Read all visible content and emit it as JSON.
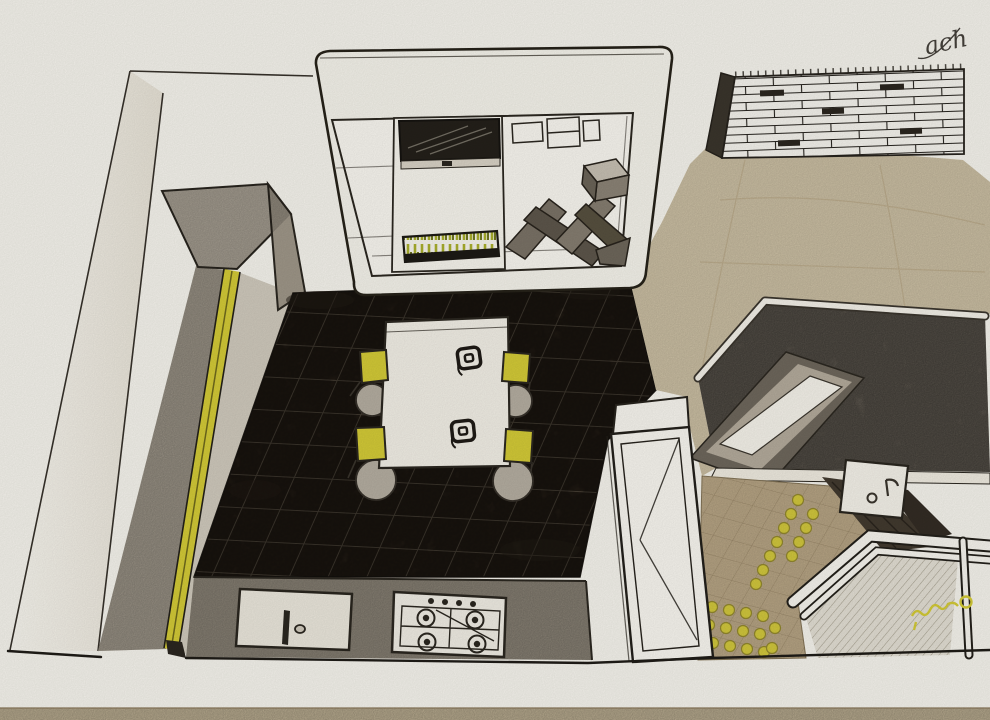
{
  "artwork": {
    "type": "hand-drawn interior perspective sketch",
    "subject": "kitchen with dining table, suspended cabinet unit, counters and tiled floors",
    "view": "bird's-eye perspective",
    "medium": "pencil and colored pencil on paper",
    "signature_top_right": "ach",
    "signature_bottom_right_style": "yellow pencil flourish"
  },
  "palette": {
    "paper": "#f5f3ec",
    "pencil": "#2b2720",
    "accent_yellow": "#d3ca37",
    "grass_green": "#a9af2c",
    "dark_tile": "#33291f",
    "tile_joint": "#9a8c76",
    "counter_gray": "#9a9284",
    "cabinet_gray": "#b5ad9f",
    "tan_floor": "#dccfb1",
    "tan_tile": "#c8b491",
    "granite": "#91887b",
    "wall_white": "#f2f0e8"
  },
  "scene": {
    "chair_count": 4,
    "hob_burner_count": 4,
    "hob_knob_count": 4,
    "place_setting_count": 2,
    "objects": [
      "left wall",
      "tall cabinet",
      "wall counter run with yellow edge strip",
      "suspended cabinet unit",
      "wall-mounted tv",
      "zigzag display shelf",
      "grass planter box",
      "dining table",
      "place settings",
      "yellow chairs",
      "dark tiled kitchen floor",
      "kitchen counter with sink",
      "4-burner gas hob",
      "brick wall",
      "stone-top island counter",
      "inset basin",
      "small square sink",
      "open door",
      "glass partition",
      "tan tiled floor with yellow dots"
    ]
  }
}
